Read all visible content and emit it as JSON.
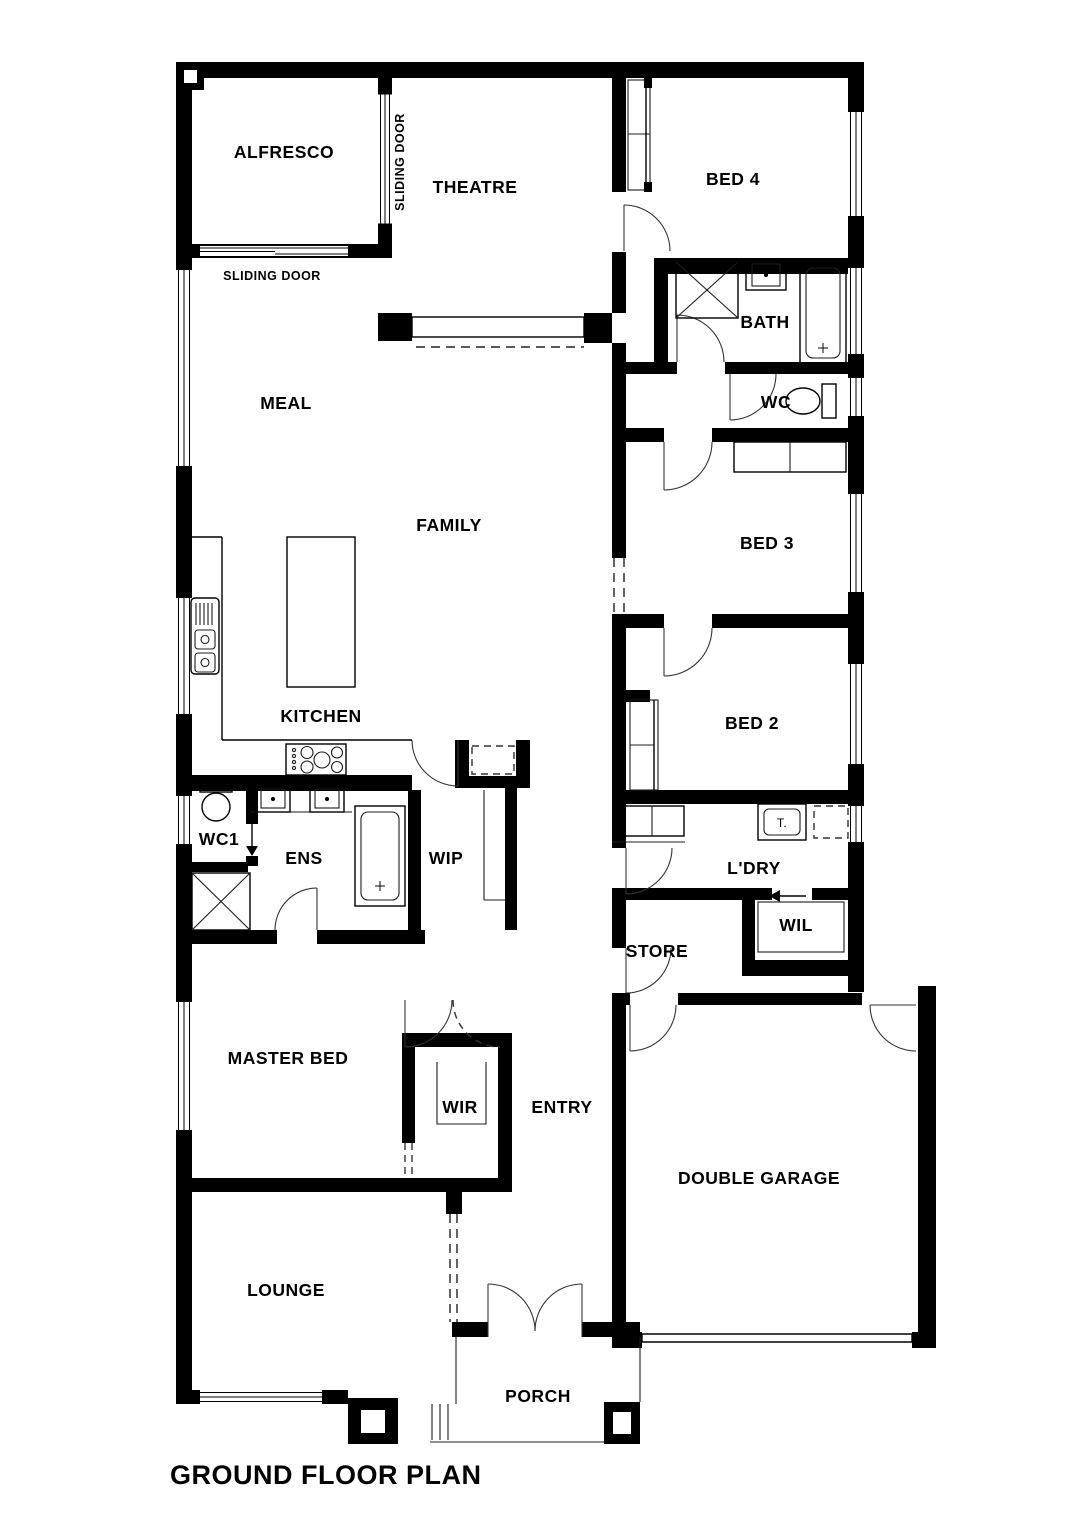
{
  "title": "GROUND FLOOR PLAN",
  "rooms": {
    "alfresco": "ALFRESCO",
    "theatre": "THEATRE",
    "bed4": "BED 4",
    "bath": "BATH",
    "wc": "WC",
    "meal": "MEAL",
    "family": "FAMILY",
    "bed3": "BED 3",
    "kitchen": "KITCHEN",
    "bed2": "BED 2",
    "wc1": "WC1",
    "ens": "ENS",
    "wip": "WIP",
    "ldry": "L'DRY",
    "wil": "WIL",
    "store": "STORE",
    "master_bed": "MASTER BED",
    "wir": "WIR",
    "entry": "ENTRY",
    "double_garage": "DOUBLE GARAGE",
    "lounge": "LOUNGE",
    "porch": "PORCH"
  },
  "annotations": {
    "sliding_door_theatre": "SLIDING DOOR",
    "sliding_door_alfresco": "SLIDING DOOR",
    "laundry_trough": "T."
  },
  "colors": {
    "wall": "#000000",
    "background": "#ffffff",
    "line": "#1c1c1c"
  }
}
